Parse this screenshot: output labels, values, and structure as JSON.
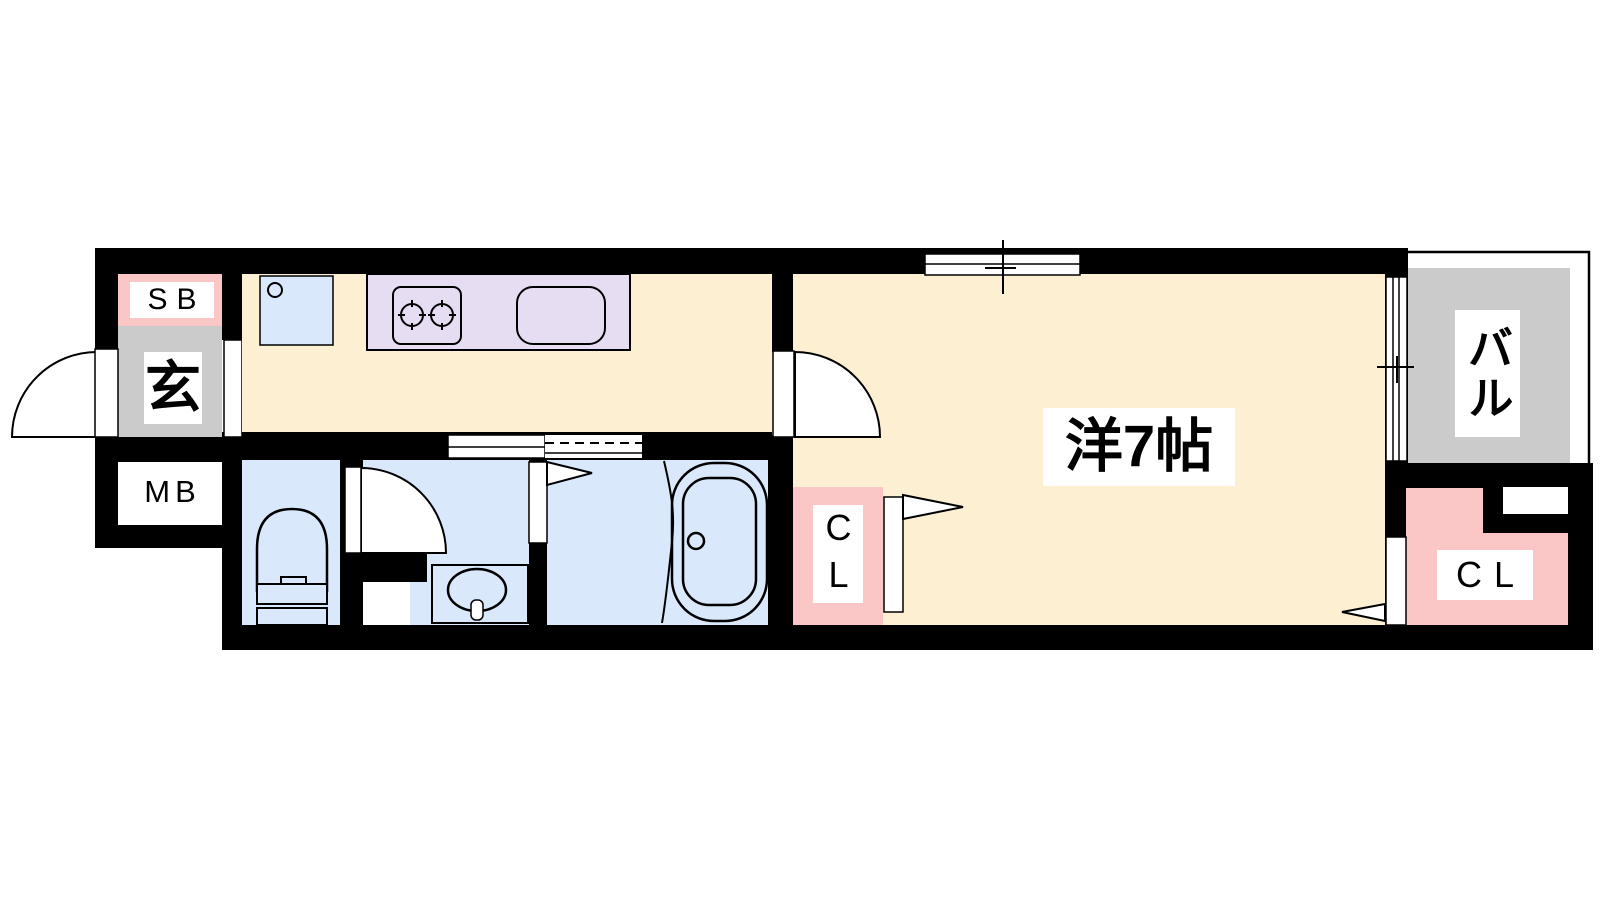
{
  "plan": {
    "rooms": {
      "shoe_box": {
        "label": "SB"
      },
      "entrance": {
        "label": "玄"
      },
      "meter_box": {
        "label": "MB"
      },
      "hall_closet": {
        "label": "CL"
      },
      "western_room": {
        "label": "洋7帖"
      },
      "balcony": {
        "label": "バル"
      },
      "room_closet": {
        "label": "CL"
      }
    }
  },
  "colors": {
    "wall": "#000000",
    "floor": "#FCEFD2",
    "wet": "#D9E8FA",
    "counter": "#E7DDF3",
    "closet": "#FBC7C6",
    "gray": "#CBCBCB"
  }
}
